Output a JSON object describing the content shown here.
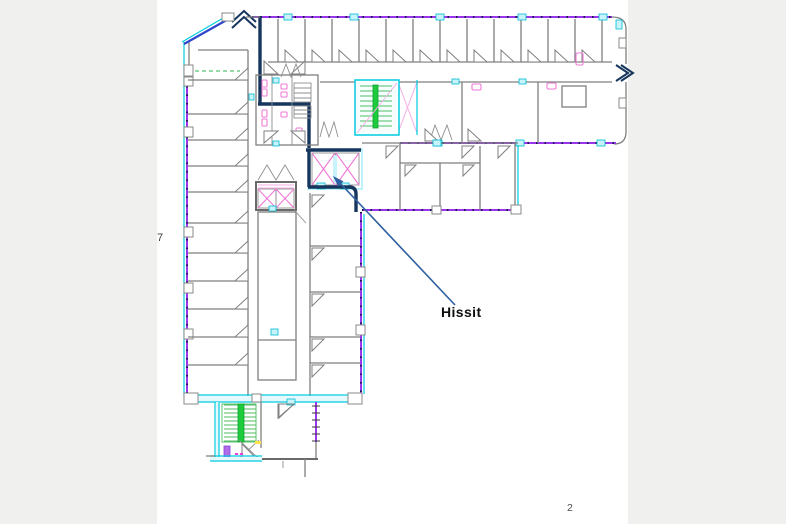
{
  "window": {
    "background": "#f0f0ef"
  },
  "document": {
    "page_background": "#ffffff",
    "page_number": "2",
    "stray_mark": "7"
  },
  "annotation": {
    "label": "Hissit",
    "arrow_color": "#2e5fa0",
    "text_color": "#0d0d0d"
  },
  "drawing": {
    "type": "floor-plan",
    "colors": {
      "route_navy": "#17365d",
      "exterior_wall_purple": "#9a35ea",
      "glazing_cyan": "#00cbe0",
      "wall_gray": "#7f7f7f",
      "stair_green": "#1ecb3c",
      "elevator_pink": "#ef7ad6",
      "entry_slant_blue": "#2f45cc",
      "highlight_yellow": "#ffe14d"
    },
    "icons": [
      "entrance-chevron-icon",
      "exit-chevron-icon",
      "elevator-cross-icon",
      "stair-icon",
      "door-swing-icon"
    ]
  }
}
